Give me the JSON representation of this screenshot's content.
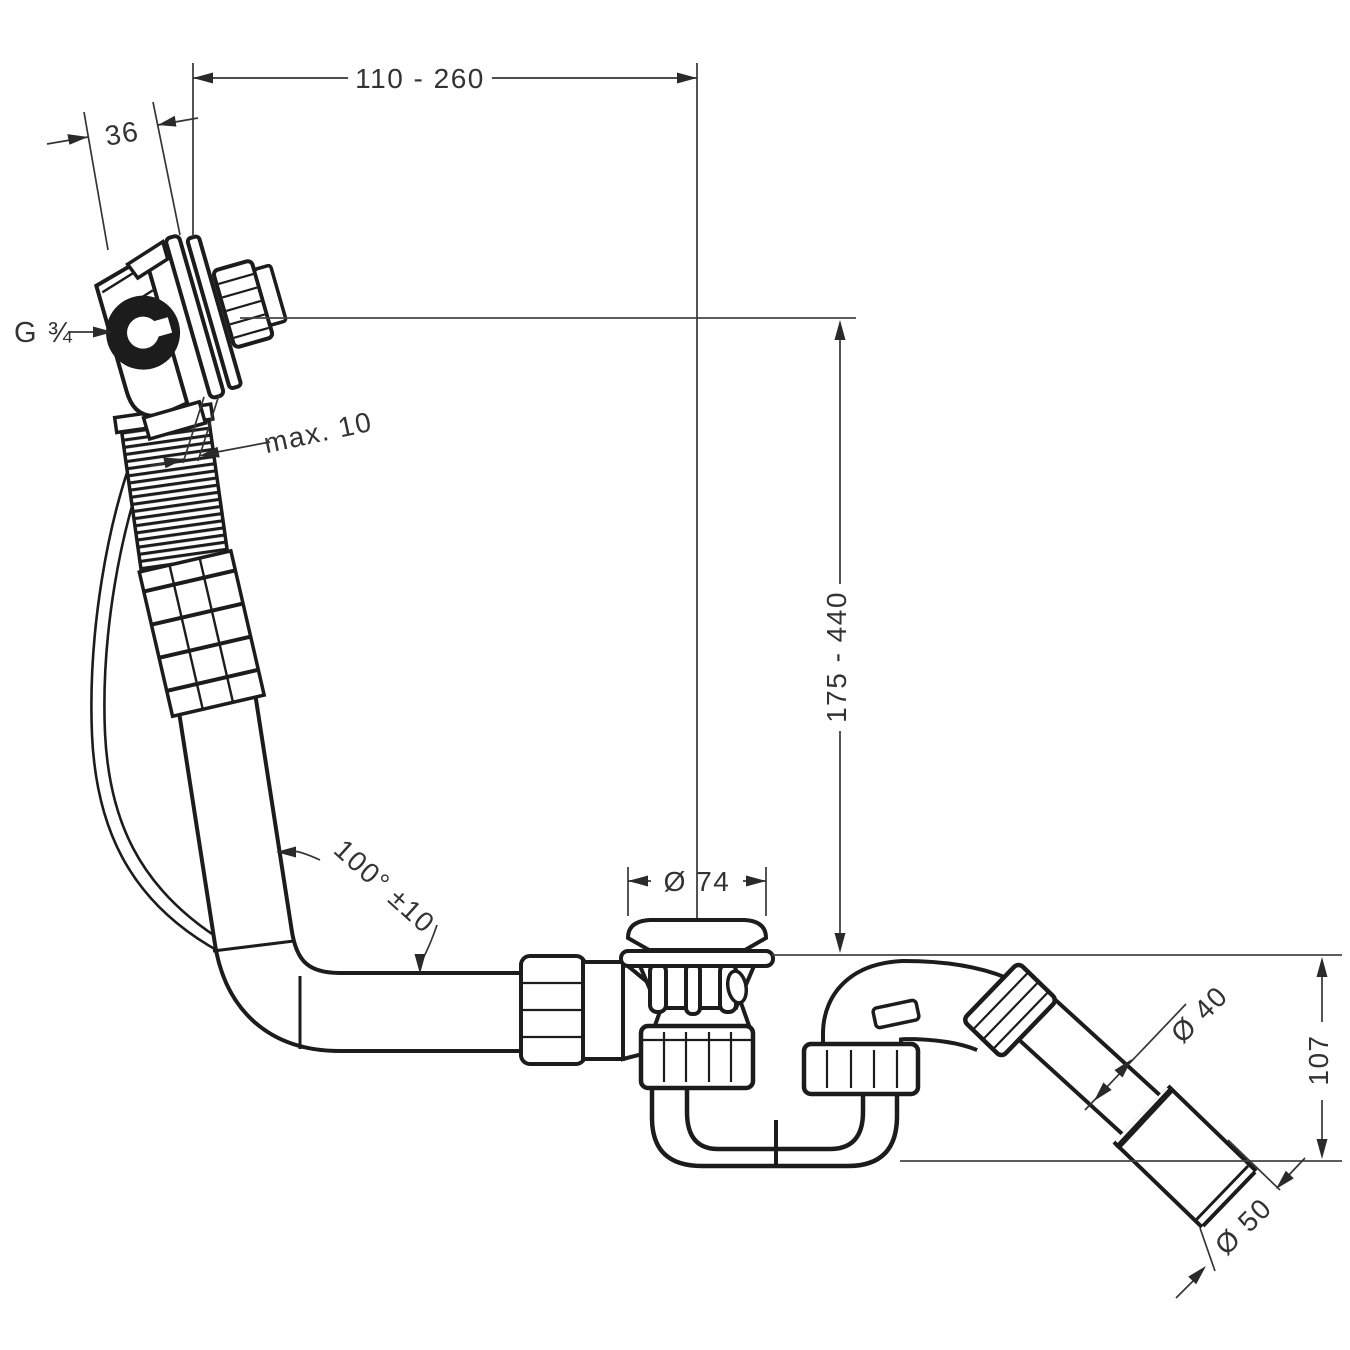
{
  "drawing": {
    "labels": {
      "span_range": "110 - 260",
      "wall_offset": "36",
      "thread_size": "G ¾",
      "max_gap": "max. 10",
      "height_range": "175 - 440",
      "waste_diameter": "Ø 74",
      "hose_angle": "100° ±10",
      "outlet_pipe_diameter": "Ø 40",
      "outlet_height": "107",
      "outlet_end_diameter": "Ø 50"
    },
    "colors": {
      "line": "#1c1c1c",
      "dimension": "#333333",
      "background": "#ffffff"
    }
  }
}
